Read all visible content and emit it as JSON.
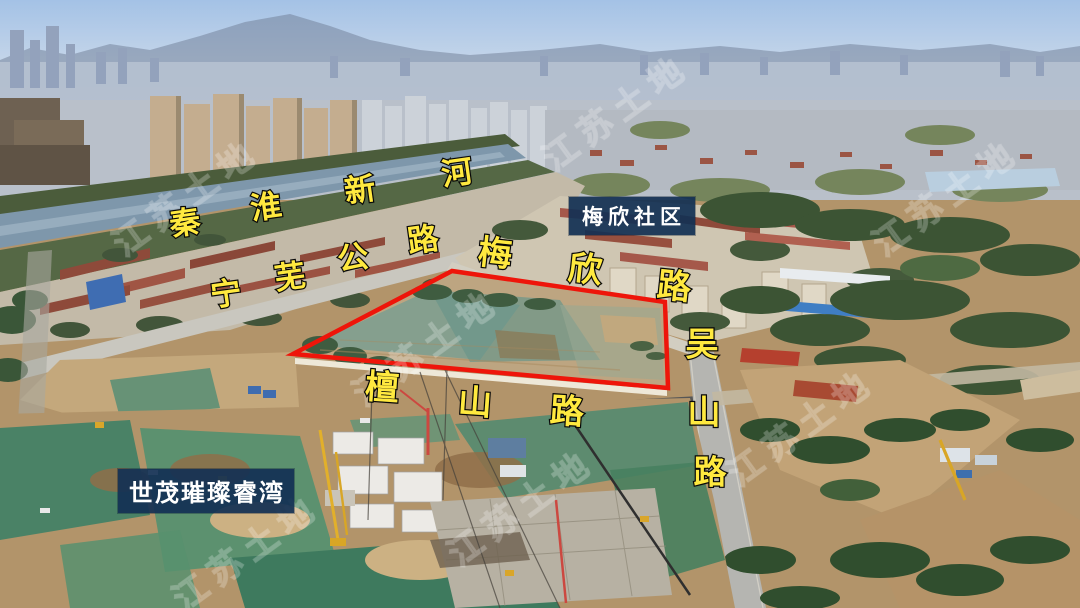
{
  "labels": {
    "qinhuai_river": {
      "text": "秦淮新河",
      "chars": [
        "秦",
        "淮",
        "新",
        "河"
      ]
    },
    "ningwu_highway": {
      "text": "宁芜公路",
      "chars": [
        "宁",
        "芜",
        "公",
        "路"
      ]
    },
    "meixin_road": {
      "text": "梅欣路",
      "chars": [
        "梅",
        "欣",
        "路"
      ]
    },
    "wushan_road": {
      "text": "吴山路",
      "chars": [
        "吴",
        "山",
        "路"
      ]
    },
    "tanshan_road": {
      "text": "檀山路",
      "chars": [
        "檀",
        "山",
        "路"
      ]
    },
    "meixin_community": {
      "text": "梅欣社区"
    },
    "shimao_project": {
      "text": "世茂璀璨睿湾"
    }
  },
  "watermark": {
    "text": "江苏土地"
  },
  "parcel": {
    "outline_color": "#ee150a"
  },
  "colors": {
    "road_label_text": "#ffe93f",
    "road_label_outline": "#000000",
    "label_box_bg": "#123054",
    "label_box_text": "#ffffff"
  }
}
